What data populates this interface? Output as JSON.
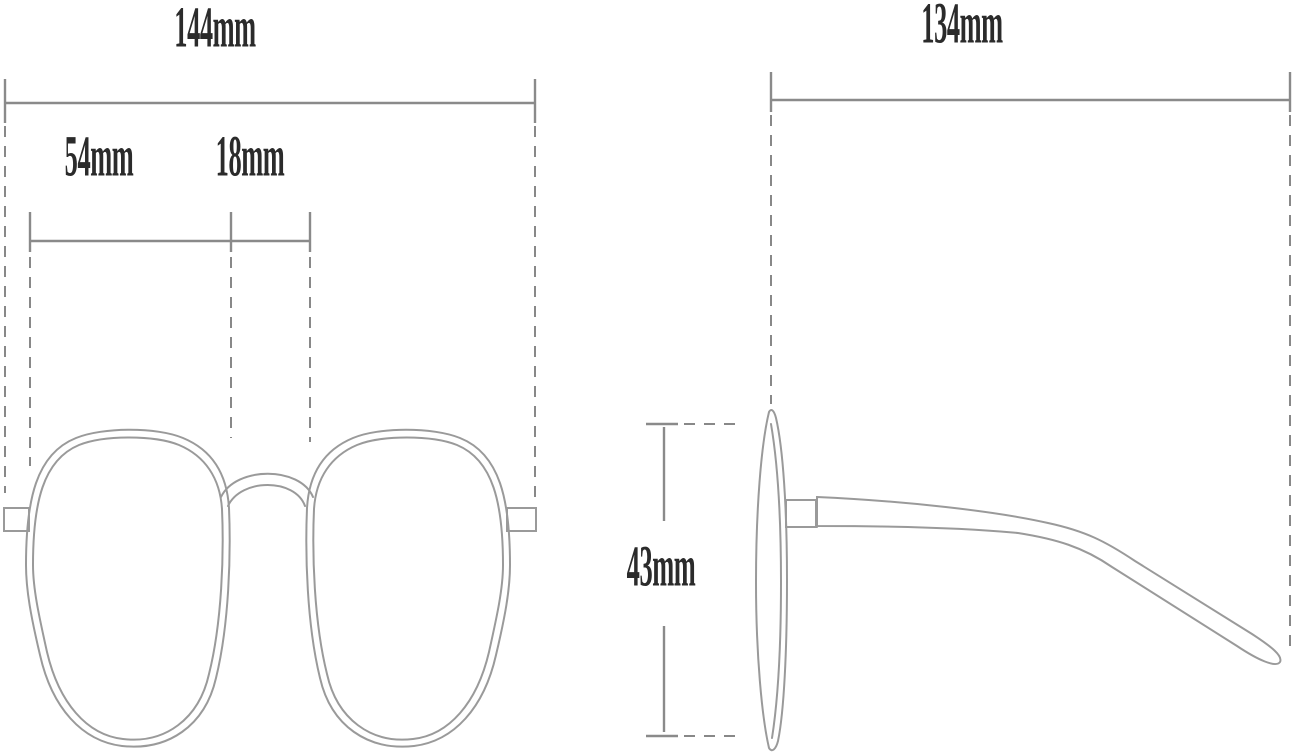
{
  "front_view": {
    "total_width_label": "144mm",
    "lens_width_label": "54mm",
    "bridge_width_label": "18mm"
  },
  "side_view": {
    "temple_length_label": "134mm",
    "lens_height_label": "43mm"
  },
  "colors": {
    "background": "#ffffff",
    "outline": "#9a9a9a",
    "dimension_line": "#8a8a8a",
    "dashed_line": "#888888",
    "label_text": "#2b2b2b"
  }
}
